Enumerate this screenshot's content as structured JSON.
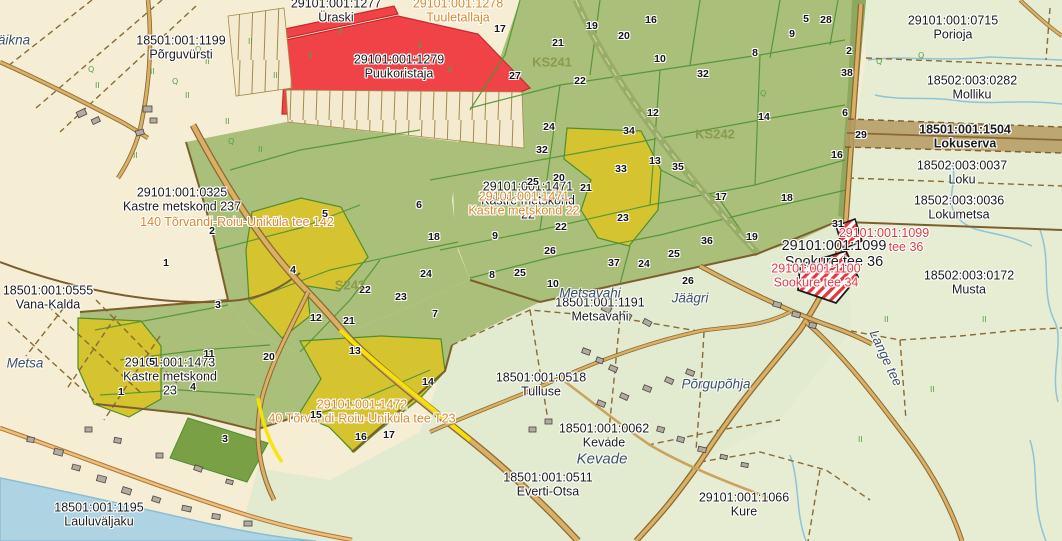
{
  "app": {
    "description": "Cadastral map view"
  },
  "colors": {
    "base_cream": "#f6eed4",
    "meadow_green": "#e4ecd2",
    "forest_green": "#a9bf7a",
    "forest_dark": "#8fa85f",
    "parcel_yellow": "#d6c330",
    "parcel_dark_green": "#79a044",
    "parcel_red": "#f04348",
    "road_fill": "#d9b066",
    "road_casing": "#8a6a32",
    "road_highlight": "#f8e400",
    "water": "#aed3e3",
    "stream": "#8fc3d8",
    "boundary_brown": "#8a6a32",
    "green_line": "#4e8f2d",
    "strip_brown": "#b49a62",
    "label_black": "#1c1c1c",
    "label_orange": "#d8892e",
    "label_red": "#e23b43",
    "label_olive": "#8a9748",
    "label_place": "#3d5166",
    "selection_hatch": "#e8353a"
  },
  "map": {
    "cadastral_labels": [
      {
        "lines": [
          "29101:001:1277",
          "Üraski"
        ],
        "x": 336,
        "y": 11,
        "color": "black"
      },
      {
        "lines": [
          "29101:001:1278",
          "Tuuletallaja"
        ],
        "x": 458,
        "y": 11,
        "color": "orange"
      },
      {
        "lines": [
          "29101:001:1279",
          "Puukoristaja"
        ],
        "x": 399,
        "y": 67,
        "color": "black"
      },
      {
        "lines": [
          "18501:001:1199",
          "Põrguvürsti"
        ],
        "x": 181,
        "y": 48,
        "color": "black"
      },
      {
        "lines": [
          "29101:001:0715",
          "Porioja"
        ],
        "x": 953,
        "y": 28,
        "color": "black"
      },
      {
        "lines": [
          "18502:003:0282",
          "Molliku"
        ],
        "x": 972,
        "y": 88,
        "color": "black"
      },
      {
        "lines": [
          "18501:001:1504",
          "Lokuserva"
        ],
        "x": 965,
        "y": 137,
        "color": "black",
        "bold": true
      },
      {
        "lines": [
          "18502:003:0037",
          "Loku"
        ],
        "x": 962,
        "y": 173,
        "color": "black"
      },
      {
        "lines": [
          "18502:003:0036",
          "Lokumetsa"
        ],
        "x": 959,
        "y": 208,
        "color": "black"
      },
      {
        "lines": [
          "18502:003:0172",
          "Musta"
        ],
        "x": 969,
        "y": 283,
        "color": "black"
      },
      {
        "lines": [
          "29101:001:0325",
          "Kastre metskond 237"
        ],
        "x": 182,
        "y": 200,
        "color": "black"
      },
      {
        "lines": [
          "29101:001:1471",
          "Kastre metskond",
          "22"
        ],
        "x": 528,
        "y": 201,
        "color": "black"
      },
      {
        "lines": [
          "29101:001:1471",
          "Kastre metskond 22"
        ],
        "x": 524,
        "y": 204,
        "color": "orange"
      },
      {
        "lines": [
          "140 Tõrvandi-Roiu-Uniküla tee 142"
        ],
        "x": 237,
        "y": 223,
        "color": "orange"
      },
      {
        "lines": [
          "18501:001:1191",
          "Metsavahi"
        ],
        "x": 600,
        "y": 310,
        "color": "black"
      },
      {
        "lines": [
          "18501:001:0555",
          "Vana-Kalda"
        ],
        "x": 48,
        "y": 298,
        "color": "black"
      },
      {
        "lines": [
          "29101:001:1473",
          "Kastre metskond",
          "23"
        ],
        "x": 170,
        "y": 377,
        "color": "black"
      },
      {
        "lines": [
          "29101:001:1472",
          "40 Tõrvandi-Roiu-Uniküla tee T23"
        ],
        "x": 362,
        "y": 412,
        "color": "orange"
      },
      {
        "lines": [
          "18501:001:0518",
          "Tulluse"
        ],
        "x": 541,
        "y": 385,
        "color": "black"
      },
      {
        "lines": [
          "18501:001:0062",
          "Kevade"
        ],
        "x": 604,
        "y": 436,
        "color": "black"
      },
      {
        "lines": [
          "18501:001:0511",
          "Everti-Otsa"
        ],
        "x": 548,
        "y": 485,
        "color": "black"
      },
      {
        "lines": [
          "29101:001:1066",
          "Kure"
        ],
        "x": 744,
        "y": 505,
        "color": "black"
      },
      {
        "lines": [
          "18501:001:1195",
          "Lauluväljaku"
        ],
        "x": 99,
        "y": 515,
        "color": "black"
      },
      {
        "lines": [
          "29101:001:1099",
          "Sookure tee 36"
        ],
        "x": 834,
        "y": 255,
        "color": "black",
        "size": 14.5
      },
      {
        "lines": [
          "29101:001:1099"
        ],
        "x": 884,
        "y": 234,
        "color": "red"
      },
      {
        "lines": [
          "tee 36"
        ],
        "x": 906,
        "y": 248,
        "color": "red"
      },
      {
        "lines": [
          "29101:001:1100",
          "Sookure tee 34"
        ],
        "x": 816,
        "y": 276,
        "color": "red"
      }
    ],
    "zone_labels": [
      {
        "text": "KS241",
        "x": 552,
        "y": 62
      },
      {
        "text": "KS242",
        "x": 715,
        "y": 134
      },
      {
        "text": "S242",
        "x": 350,
        "y": 285
      }
    ],
    "place_names": [
      {
        "text": "äikna",
        "x": 14,
        "y": 40
      },
      {
        "text": "Metsa",
        "x": 25,
        "y": 363
      },
      {
        "text": "Metsavahi",
        "x": 590,
        "y": 293
      },
      {
        "text": "Jäägri",
        "x": 690,
        "y": 298
      },
      {
        "text": "Kevade",
        "x": 602,
        "y": 459,
        "size": 15
      },
      {
        "text": "Põrgupõhja",
        "x": 716,
        "y": 384
      },
      {
        "text": "Lange tee",
        "x": 886,
        "y": 358,
        "rotate": 65
      }
    ],
    "parcel_numbers": [
      {
        "n": "17",
        "x": 500,
        "y": 29
      },
      {
        "n": "19",
        "x": 592,
        "y": 26
      },
      {
        "n": "16",
        "x": 651,
        "y": 20
      },
      {
        "n": "20",
        "x": 624,
        "y": 36
      },
      {
        "n": "21",
        "x": 558,
        "y": 43
      },
      {
        "n": "10",
        "x": 660,
        "y": 59
      },
      {
        "n": "8",
        "x": 755,
        "y": 53
      },
      {
        "n": "9",
        "x": 792,
        "y": 34
      },
      {
        "n": "5",
        "x": 806,
        "y": 19
      },
      {
        "n": "28",
        "x": 826,
        "y": 20
      },
      {
        "n": "2",
        "x": 849,
        "y": 51
      },
      {
        "n": "38",
        "x": 847,
        "y": 73
      },
      {
        "n": "32",
        "x": 703,
        "y": 74
      },
      {
        "n": "27",
        "x": 515,
        "y": 76
      },
      {
        "n": "22",
        "x": 580,
        "y": 81
      },
      {
        "n": "6",
        "x": 845,
        "y": 113
      },
      {
        "n": "14",
        "x": 764,
        "y": 117
      },
      {
        "n": "12",
        "x": 653,
        "y": 113
      },
      {
        "n": "34",
        "x": 629,
        "y": 131
      },
      {
        "n": "24",
        "x": 549,
        "y": 127
      },
      {
        "n": "32",
        "x": 542,
        "y": 150
      },
      {
        "n": "16",
        "x": 837,
        "y": 155
      },
      {
        "n": "13",
        "x": 655,
        "y": 161
      },
      {
        "n": "35",
        "x": 678,
        "y": 167
      },
      {
        "n": "33",
        "x": 621,
        "y": 169
      },
      {
        "n": "25",
        "x": 533,
        "y": 182
      },
      {
        "n": "20",
        "x": 559,
        "y": 178
      },
      {
        "n": "21",
        "x": 586,
        "y": 188
      },
      {
        "n": "17",
        "x": 721,
        "y": 197
      },
      {
        "n": "18",
        "x": 787,
        "y": 198
      },
      {
        "n": "29",
        "x": 861,
        "y": 135
      },
      {
        "n": "23",
        "x": 623,
        "y": 218
      },
      {
        "n": "22",
        "x": 561,
        "y": 227
      },
      {
        "n": "9",
        "x": 495,
        "y": 236
      },
      {
        "n": "18",
        "x": 434,
        "y": 237
      },
      {
        "n": "26",
        "x": 550,
        "y": 251
      },
      {
        "n": "36",
        "x": 707,
        "y": 241
      },
      {
        "n": "19",
        "x": 752,
        "y": 237
      },
      {
        "n": "31",
        "x": 838,
        "y": 224
      },
      {
        "n": "25",
        "x": 674,
        "y": 254
      },
      {
        "n": "24",
        "x": 644,
        "y": 264
      },
      {
        "n": "37",
        "x": 614,
        "y": 263
      },
      {
        "n": "26",
        "x": 688,
        "y": 281
      },
      {
        "n": "10",
        "x": 553,
        "y": 284
      },
      {
        "n": "25",
        "x": 520,
        "y": 273
      },
      {
        "n": "5",
        "x": 325,
        "y": 214
      },
      {
        "n": "6",
        "x": 419,
        "y": 205
      },
      {
        "n": "2",
        "x": 212,
        "y": 231
      },
      {
        "n": "4",
        "x": 293,
        "y": 270
      },
      {
        "n": "24",
        "x": 426,
        "y": 274
      },
      {
        "n": "8",
        "x": 492,
        "y": 275
      },
      {
        "n": "22",
        "x": 365,
        "y": 290
      },
      {
        "n": "23",
        "x": 401,
        "y": 297
      },
      {
        "n": "12",
        "x": 316,
        "y": 318
      },
      {
        "n": "21",
        "x": 349,
        "y": 321
      },
      {
        "n": "7",
        "x": 435,
        "y": 314
      },
      {
        "n": "1",
        "x": 166,
        "y": 263
      },
      {
        "n": "3",
        "x": 218,
        "y": 305
      },
      {
        "n": "11",
        "x": 209,
        "y": 354
      },
      {
        "n": "20",
        "x": 269,
        "y": 357
      },
      {
        "n": "5",
        "x": 152,
        "y": 362
      },
      {
        "n": "1",
        "x": 121,
        "y": 392
      },
      {
        "n": "4",
        "x": 193,
        "y": 387
      },
      {
        "n": "13",
        "x": 355,
        "y": 351
      },
      {
        "n": "14",
        "x": 428,
        "y": 382
      },
      {
        "n": "15",
        "x": 316,
        "y": 415
      },
      {
        "n": "16",
        "x": 361,
        "y": 437
      },
      {
        "n": "17",
        "x": 389,
        "y": 435
      },
      {
        "n": "3",
        "x": 225,
        "y": 439
      }
    ],
    "selection": {
      "hatched_parcels_note": "red diagonal hatch near Sookure tee parcels",
      "road_highlight": "yellow segment on Tõrvandi-Roiu-Uniküla road"
    }
  }
}
